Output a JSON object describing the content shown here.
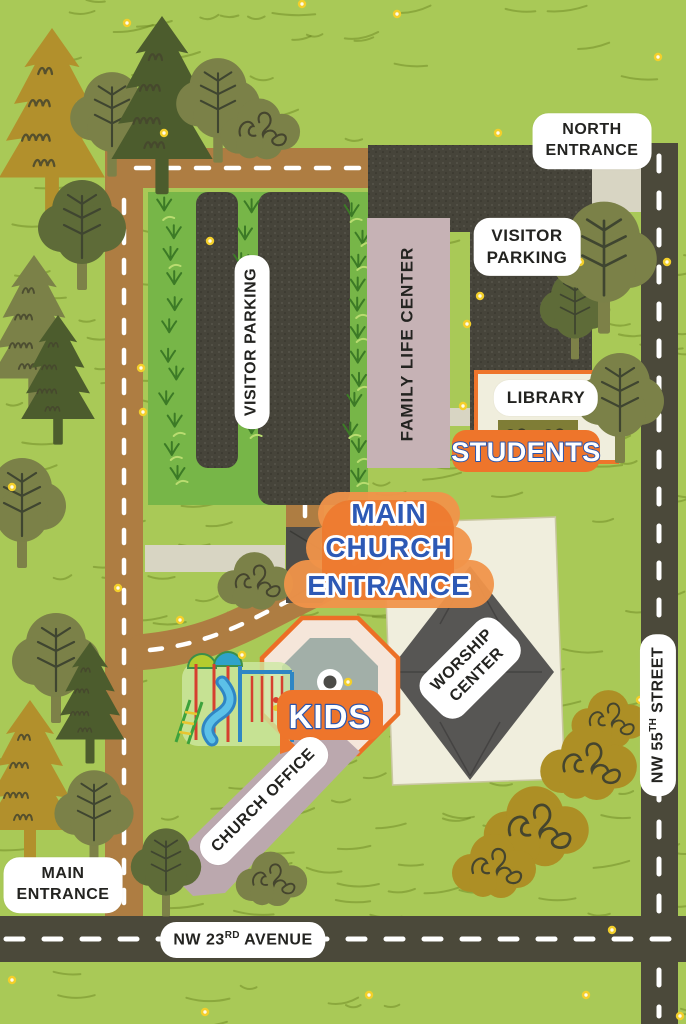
{
  "title": "Church Campus Map",
  "colors": {
    "grass": "#a9c957",
    "grass_stroke": "#66801e",
    "road_brown": "#ae7d42",
    "road_dark": "#4b493a",
    "dash": "#ffffff",
    "parking": "#46443a",
    "strip_green": "#77b648",
    "tuft": "#3c7a26",
    "tuft_light": "#b9dc70",
    "sidewalk": "#d8d5c3",
    "building_pink": "#c6b2b5",
    "office_pink": "#bba8ae",
    "cream": "#f0eedd",
    "worship_gray": "#575654",
    "canopy_gray": "#4e4d49",
    "orange": "#ee752b",
    "orange_light": "#f0934a",
    "blue": "#2d59b5",
    "ink": "#232320",
    "hedge": "#7f7d36",
    "octagon_face": "#f5e6da",
    "octagon_inner": "#a2afa8",
    "scribble": "#45452e",
    "mustard": "#ad8f25",
    "olive": "#7b8148",
    "darkolive": "#5e6b38",
    "darkpine": "#4c5c2d",
    "pine_mustard": "#b2902c",
    "dot": "#f3cf2a"
  },
  "labels": {
    "north_entrance": {
      "line1": "NORTH",
      "line2": "ENTRANCE"
    },
    "visitor_parking_left": "VISITOR PARKING",
    "visitor_parking_right": {
      "line1": "VISITOR",
      "line2": "PARKING"
    },
    "family_life_center": {
      "line1": "FAMILY LIFE",
      "line2": "CENTER"
    },
    "library": "LIBRARY",
    "students": "STUDENTS",
    "main_church_entrance": {
      "line1": "MAIN",
      "line2": "CHURCH",
      "line3": "ENTRANCE"
    },
    "kids": "KIDS",
    "worship_center": {
      "line1": "WORSHIP",
      "line2": "CENTER"
    },
    "church_office": "CHURCH OFFICE",
    "main_entrance": {
      "line1": "MAIN",
      "line2": "ENTRANCE"
    },
    "nw23_avenue": {
      "prefix": "NW 23",
      "sup": "RD",
      "suffix": " AVENUE"
    },
    "nw55_street": {
      "prefix": "NW 55",
      "sup": "TH",
      "suffix": " STREET"
    }
  },
  "decor": {
    "trees": [
      {
        "t": "pine",
        "c": "pine_mustard",
        "x": 52,
        "y": 28,
        "s": 1.15
      },
      {
        "t": "round",
        "c": "olive",
        "x": 112,
        "y": 112,
        "s": 0.95
      },
      {
        "t": "pine",
        "c": "darkpine",
        "x": 162,
        "y": 16,
        "s": 1.1
      },
      {
        "t": "round",
        "c": "olive",
        "x": 218,
        "y": 98,
        "s": 0.95
      },
      {
        "t": "bush",
        "c": "olive",
        "x": 263,
        "y": 128,
        "s": 0.95
      },
      {
        "t": "round",
        "c": "darkolive",
        "x": 82,
        "y": 222,
        "s": 1.0
      },
      {
        "t": "pine",
        "c": "olive",
        "x": 34,
        "y": 255,
        "s": 0.95
      },
      {
        "t": "pine",
        "c": "darkpine",
        "x": 58,
        "y": 315,
        "s": 0.8
      },
      {
        "t": "round",
        "c": "olive",
        "x": 22,
        "y": 500,
        "s": 1.0
      },
      {
        "t": "round",
        "c": "darkolive",
        "x": 575,
        "y": 305,
        "s": 0.8
      },
      {
        "t": "round",
        "c": "olive",
        "x": 604,
        "y": 252,
        "s": 1.2
      },
      {
        "t": "round",
        "c": "olive",
        "x": 620,
        "y": 395,
        "s": 1.0
      },
      {
        "t": "bush",
        "c": "olive",
        "x": 258,
        "y": 580,
        "s": 0.9
      },
      {
        "t": "round",
        "c": "olive",
        "x": 56,
        "y": 655,
        "s": 1.0
      },
      {
        "t": "pine",
        "c": "darkpine",
        "x": 90,
        "y": 642,
        "s": 0.75
      },
      {
        "t": "pine",
        "c": "pine_mustard",
        "x": 30,
        "y": 700,
        "s": 1.0
      },
      {
        "t": "round",
        "c": "olive",
        "x": 94,
        "y": 808,
        "s": 0.9
      },
      {
        "t": "round",
        "c": "darkolive",
        "x": 166,
        "y": 862,
        "s": 0.8
      },
      {
        "t": "bush",
        "c": "olive",
        "x": 274,
        "y": 878,
        "s": 0.85
      },
      {
        "t": "bush",
        "c": "mustard",
        "x": 612,
        "y": 718,
        "s": 0.9
      },
      {
        "t": "bush",
        "c": "mustard",
        "x": 592,
        "y": 762,
        "s": 1.15
      },
      {
        "t": "bush",
        "c": "mustard",
        "x": 540,
        "y": 825,
        "s": 1.25
      },
      {
        "t": "bush",
        "c": "mustard",
        "x": 497,
        "y": 865,
        "s": 1.0
      }
    ],
    "dots": [
      {
        "x": 397,
        "y": 14
      },
      {
        "x": 658,
        "y": 57
      },
      {
        "x": 302,
        "y": 4
      },
      {
        "x": 127,
        "y": 23
      },
      {
        "x": 164,
        "y": 133
      },
      {
        "x": 498,
        "y": 133
      },
      {
        "x": 210,
        "y": 241
      },
      {
        "x": 667,
        "y": 262
      },
      {
        "x": 580,
        "y": 262
      },
      {
        "x": 480,
        "y": 296
      },
      {
        "x": 467,
        "y": 324
      },
      {
        "x": 463,
        "y": 406
      },
      {
        "x": 141,
        "y": 368
      },
      {
        "x": 143,
        "y": 412
      },
      {
        "x": 12,
        "y": 487
      },
      {
        "x": 325,
        "y": 545
      },
      {
        "x": 118,
        "y": 588
      },
      {
        "x": 180,
        "y": 620
      },
      {
        "x": 242,
        "y": 655
      },
      {
        "x": 348,
        "y": 682
      },
      {
        "x": 640,
        "y": 700
      },
      {
        "x": 612,
        "y": 930
      },
      {
        "x": 369,
        "y": 995
      },
      {
        "x": 586,
        "y": 995
      },
      {
        "x": 100,
        "y": 868
      },
      {
        "x": 205,
        "y": 1012
      },
      {
        "x": 12,
        "y": 980
      },
      {
        "x": 680,
        "y": 1016
      }
    ]
  }
}
